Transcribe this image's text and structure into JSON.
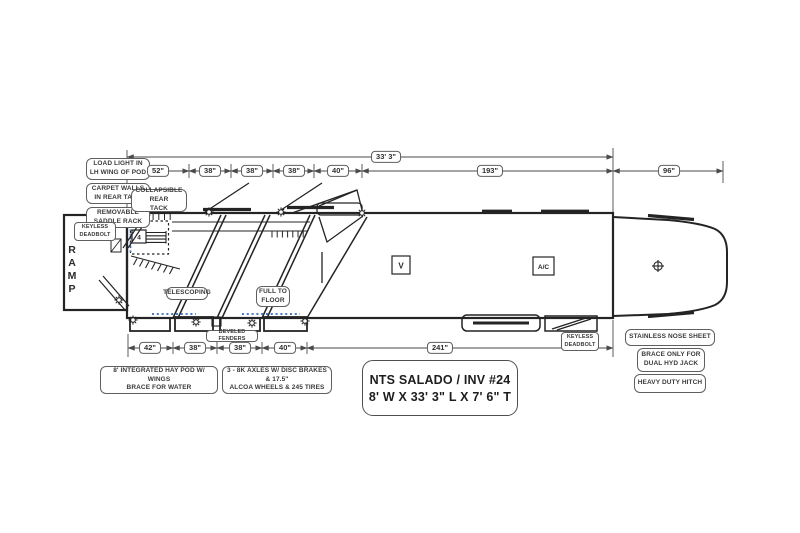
{
  "title_block": {
    "line1": "NTS SALADO / INV #24",
    "line2": "8' W X 33' 3\" L X 7' 6\" T"
  },
  "dimensions": {
    "overall_length": "33' 3\"",
    "top_row": [
      "52\"",
      "38\"",
      "38\"",
      "38\"",
      "40\"",
      "193\""
    ],
    "nose_length": "96\"",
    "bottom_row": [
      "42\"",
      "38\"",
      "38\"",
      "40\"",
      "241\""
    ]
  },
  "callouts": {
    "load_light": {
      "l1": "LOAD LIGHT IN",
      "l2": "LH WING OF POD"
    },
    "carpet_walls": {
      "l1": "CARPET WALLS",
      "l2": "IN REAR TACK"
    },
    "removable_saddle": {
      "l1": "REMOVABLE",
      "l2": "SADDLE RACK"
    },
    "keyless_rear": {
      "l1": "KEYLESS",
      "l2": "DEADBOLT"
    },
    "collapsible_tack": {
      "l1": "COLLAPSIBLE REAR",
      "l2": "TACK"
    },
    "telescoping": {
      "l1": "TELESCOPING"
    },
    "full_to_floor": {
      "l1": "FULL TO",
      "l2": "FLOOR"
    },
    "beveled_fenders": {
      "l1": "BEVELED FENDERS"
    },
    "hay_pod": {
      "l1": "8' INTEGRATED HAY POD W/ WINGS",
      "l2": "BRACE FOR WATER"
    },
    "axles": {
      "l1": "3 - 8K AXLES W/ DISC BRAKES & 17.5\"",
      "l2": "ALCOA WHEELS & 245 TIRES"
    },
    "keyless_front": {
      "l1": "KEYLESS",
      "l2": "DEADBOLT"
    },
    "stainless_nose": {
      "l1": "STAINLESS NOSE SHEET"
    },
    "brace_only": {
      "l1": "BRACE ONLY FOR",
      "l2": "DUAL HYD JACK"
    },
    "heavy_hitch": {
      "l1": "HEAVY DUTY HITCH"
    }
  },
  "interior": {
    "vent": "V",
    "ac": "A/C",
    "saddle_rack_count": "4",
    "ramp": [
      "R",
      "A",
      "M",
      "P"
    ]
  },
  "colors": {
    "line": "#242424",
    "dim_line": "#4a4a4a",
    "accent_blue": "#4a7bc8"
  }
}
